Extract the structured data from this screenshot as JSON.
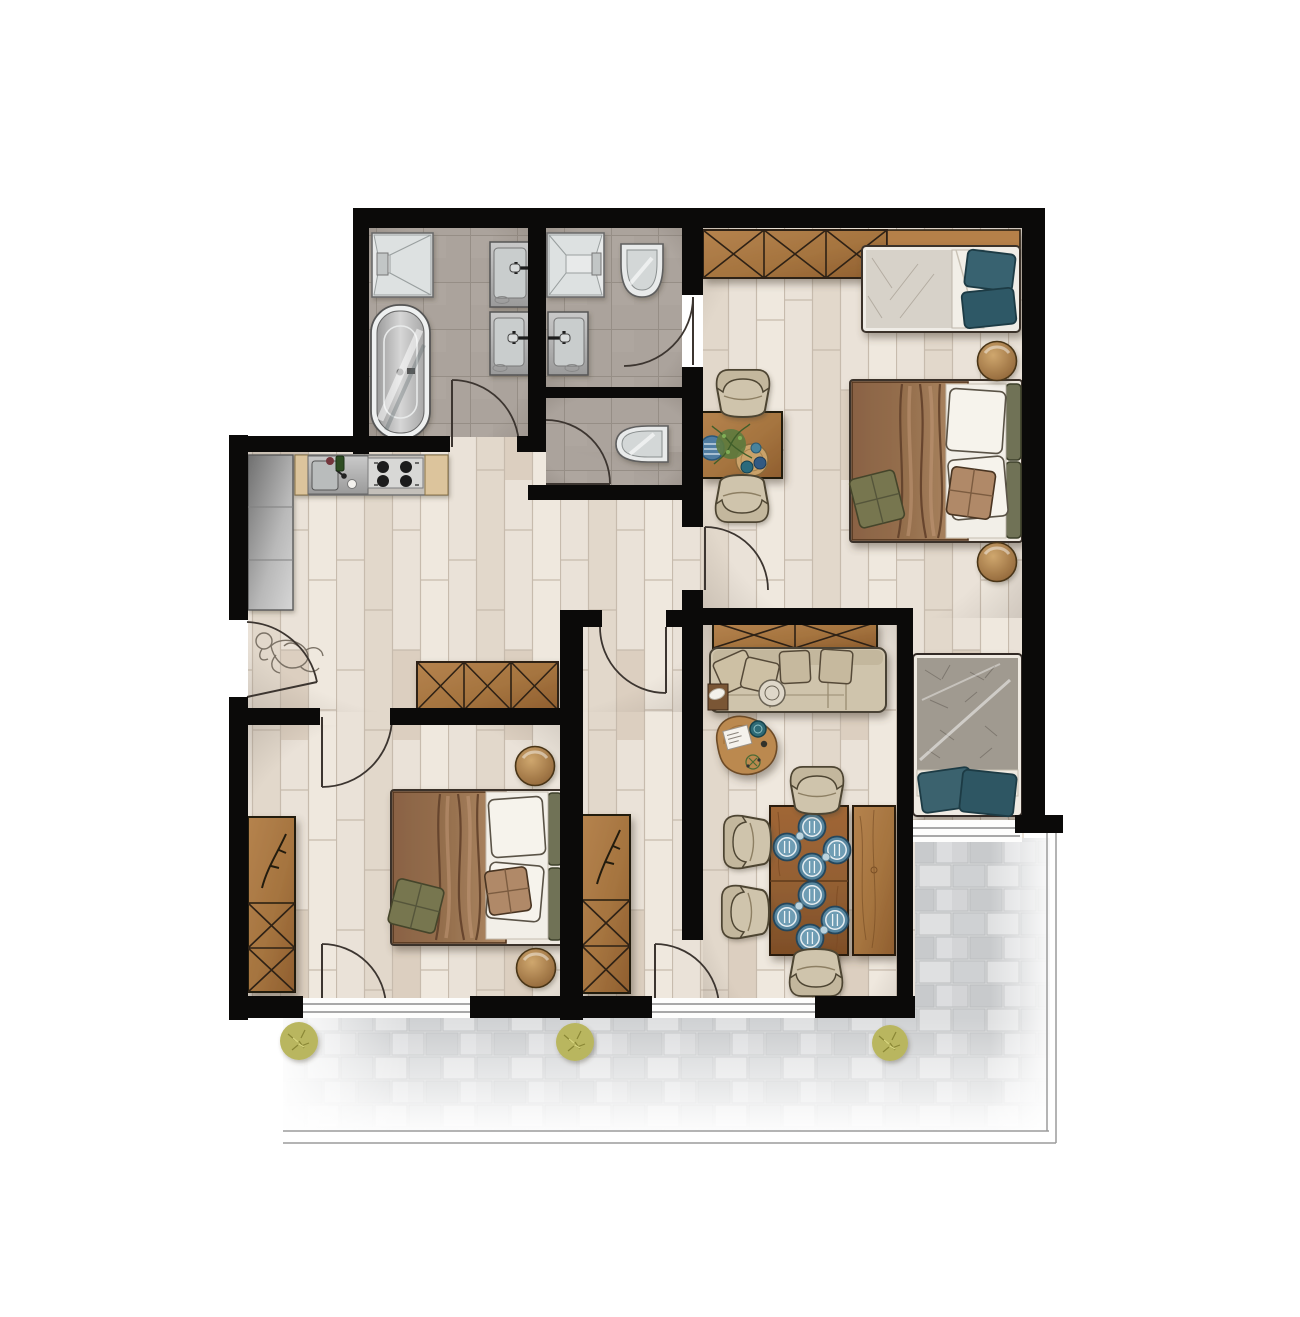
{
  "document": {
    "kind": "architectural-floor-plan",
    "style": "hand-rendered top-down furnished apartment plan with south terrace",
    "visible_text": false
  },
  "palette": {
    "background": "#ffffff",
    "wall": "#0b0a09",
    "wood_floor": "#eae2d8",
    "wood_floor_line": "#c7bbad",
    "tile_floor": "#aba39c",
    "tile_line": "#968e86",
    "paver": "#d8d9da",
    "paver_dark": "#c8cacc",
    "cabinet_wood": "#a5743f",
    "cabinet_wood_dark": "#8f5e2f",
    "table_wood": "#946033",
    "bench_wood": "#b5804a",
    "upholstery": "#cfc4ac",
    "upholstery_dark": "#c3b79d",
    "blanket_brown": "#96704e",
    "sheet_white": "#f2efe8",
    "pillow_teal": "#39626f",
    "pillow_green": "#77764f",
    "headboard_olive": "#6f7256",
    "mattress_gray": "#a09a90",
    "plate_blue": "#57869f",
    "fixture_white": "#e8eaea",
    "steel_light": "#d6d6d6",
    "steel_dark": "#9c9c9c",
    "plant_green": "#5d7a3e",
    "bush_green": "#b9b65e",
    "sketch_line": "#7b7266",
    "door_arc": "#3c3530",
    "terrace_line": "#9b9b9b"
  },
  "rooms": [
    {
      "name": "family-bathroom",
      "floor": "gray-tile",
      "fixtures": [
        "walk-in-shower",
        "freestanding-bathtub",
        "washbasin",
        "washbasin"
      ]
    },
    {
      "name": "ensuite-shower-room",
      "floor": "gray-tile",
      "fixtures": [
        "walk-in-shower",
        "washbasin",
        "wall-hung-toilet"
      ]
    },
    {
      "name": "guest-wc",
      "floor": "gray-tile",
      "fixtures": [
        "wall-hung-toilet"
      ]
    },
    {
      "name": "kitchen-hall",
      "floor": "wood-plank",
      "fixtures": [
        "tall-cabinet-run",
        "sink-counter",
        "cooktop-4-burners",
        "hall-wardrobe",
        "child-sketch-figure"
      ]
    },
    {
      "name": "bedroom-top-right",
      "floor": "wood-plank",
      "fixtures": [
        "wardrobe",
        "single-bed-teal-pillows",
        "double-bed-brown-blanket",
        "round-stool",
        "round-stool",
        "side-table-with-plant",
        "armchair",
        "armchair"
      ]
    },
    {
      "name": "living-dining-room",
      "floor": "wood-plank",
      "fixtures": [
        "sideboard",
        "three-seat-sofa",
        "organic-coffee-table",
        "dining-table-8-settings",
        "dining-bench",
        "dining-chair",
        "dining-chair",
        "dining-chair",
        "dining-chair"
      ]
    },
    {
      "name": "bed-niche",
      "floor": "wood-plank",
      "fixtures": [
        "daybed-teal-pillows"
      ]
    },
    {
      "name": "storage-corridor",
      "floor": "wood-plank",
      "fixtures": [
        "tall-sideboard-branch-decor"
      ]
    },
    {
      "name": "bedroom-bottom-left",
      "floor": "wood-plank",
      "fixtures": [
        "wardrobe-branch-decor",
        "double-bed-brown-blanket",
        "round-stool",
        "round-stool"
      ]
    },
    {
      "name": "terrace",
      "floor": "stone-pavers",
      "fixtures": [
        "bush",
        "bush",
        "bush"
      ]
    }
  ],
  "counts": {
    "double_beds": 2,
    "single_beds": 1,
    "daybeds": 1,
    "sofas": 1,
    "chairs_total": 6,
    "round_stools": 4,
    "plates_on_dining_table": 8,
    "door_swings": 9,
    "bushes": 3,
    "showers": 2,
    "toilets": 2,
    "washbasins": 3,
    "bathtubs": 1
  }
}
